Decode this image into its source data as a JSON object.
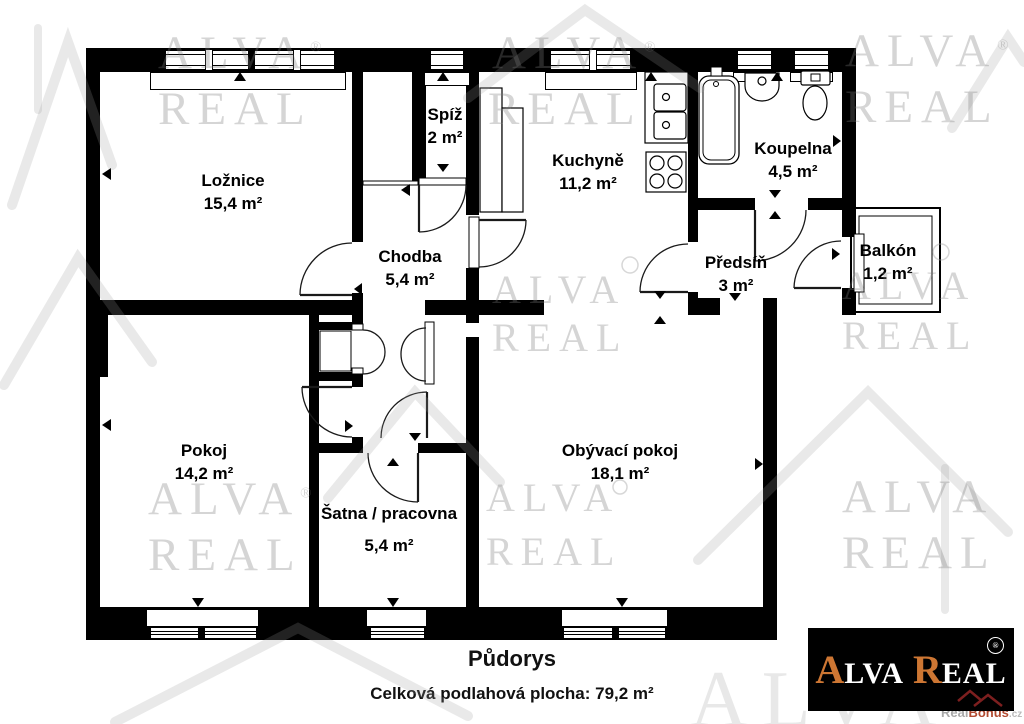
{
  "title": {
    "heading": "Půdorys",
    "subtitle": "Celková podlahová plocha: 79,2 m²"
  },
  "rooms": [
    {
      "id": "loznice",
      "name": "Ložnice",
      "area": "15,4 m²"
    },
    {
      "id": "spiz",
      "name": "Spíž",
      "area": "2 m²"
    },
    {
      "id": "kuchyne",
      "name": "Kuchyně",
      "area": "11,2 m²"
    },
    {
      "id": "koupelna",
      "name": "Koupelna",
      "area": "4,5 m²"
    },
    {
      "id": "chodba",
      "name": "Chodba",
      "area": "5,4 m²"
    },
    {
      "id": "predsin",
      "name": "Předsíň",
      "area": "3 m²"
    },
    {
      "id": "balkon",
      "name": "Balkón",
      "area": "1,2 m²"
    },
    {
      "id": "pokoj",
      "name": "Pokoj",
      "area": "14,2 m²"
    },
    {
      "id": "satna",
      "name": "Šatna / pracovna",
      "area": "5,4 m²"
    },
    {
      "id": "obyvaci",
      "name": "Obývací pokoj",
      "area": "18,1 m²"
    }
  ],
  "watermark": {
    "word1": "ALVA",
    "word2": "REAL",
    "reg": "®"
  },
  "logo": {
    "part1": "A",
    "part2": "LVA",
    "part3": "R",
    "part4": "EAL",
    "accent_color": "#cd7633",
    "bg_color": "#000000",
    "reg": "®"
  },
  "site_watermark": {
    "real": "Real",
    "bonus": "Bonus",
    "cz": ".cz"
  }
}
